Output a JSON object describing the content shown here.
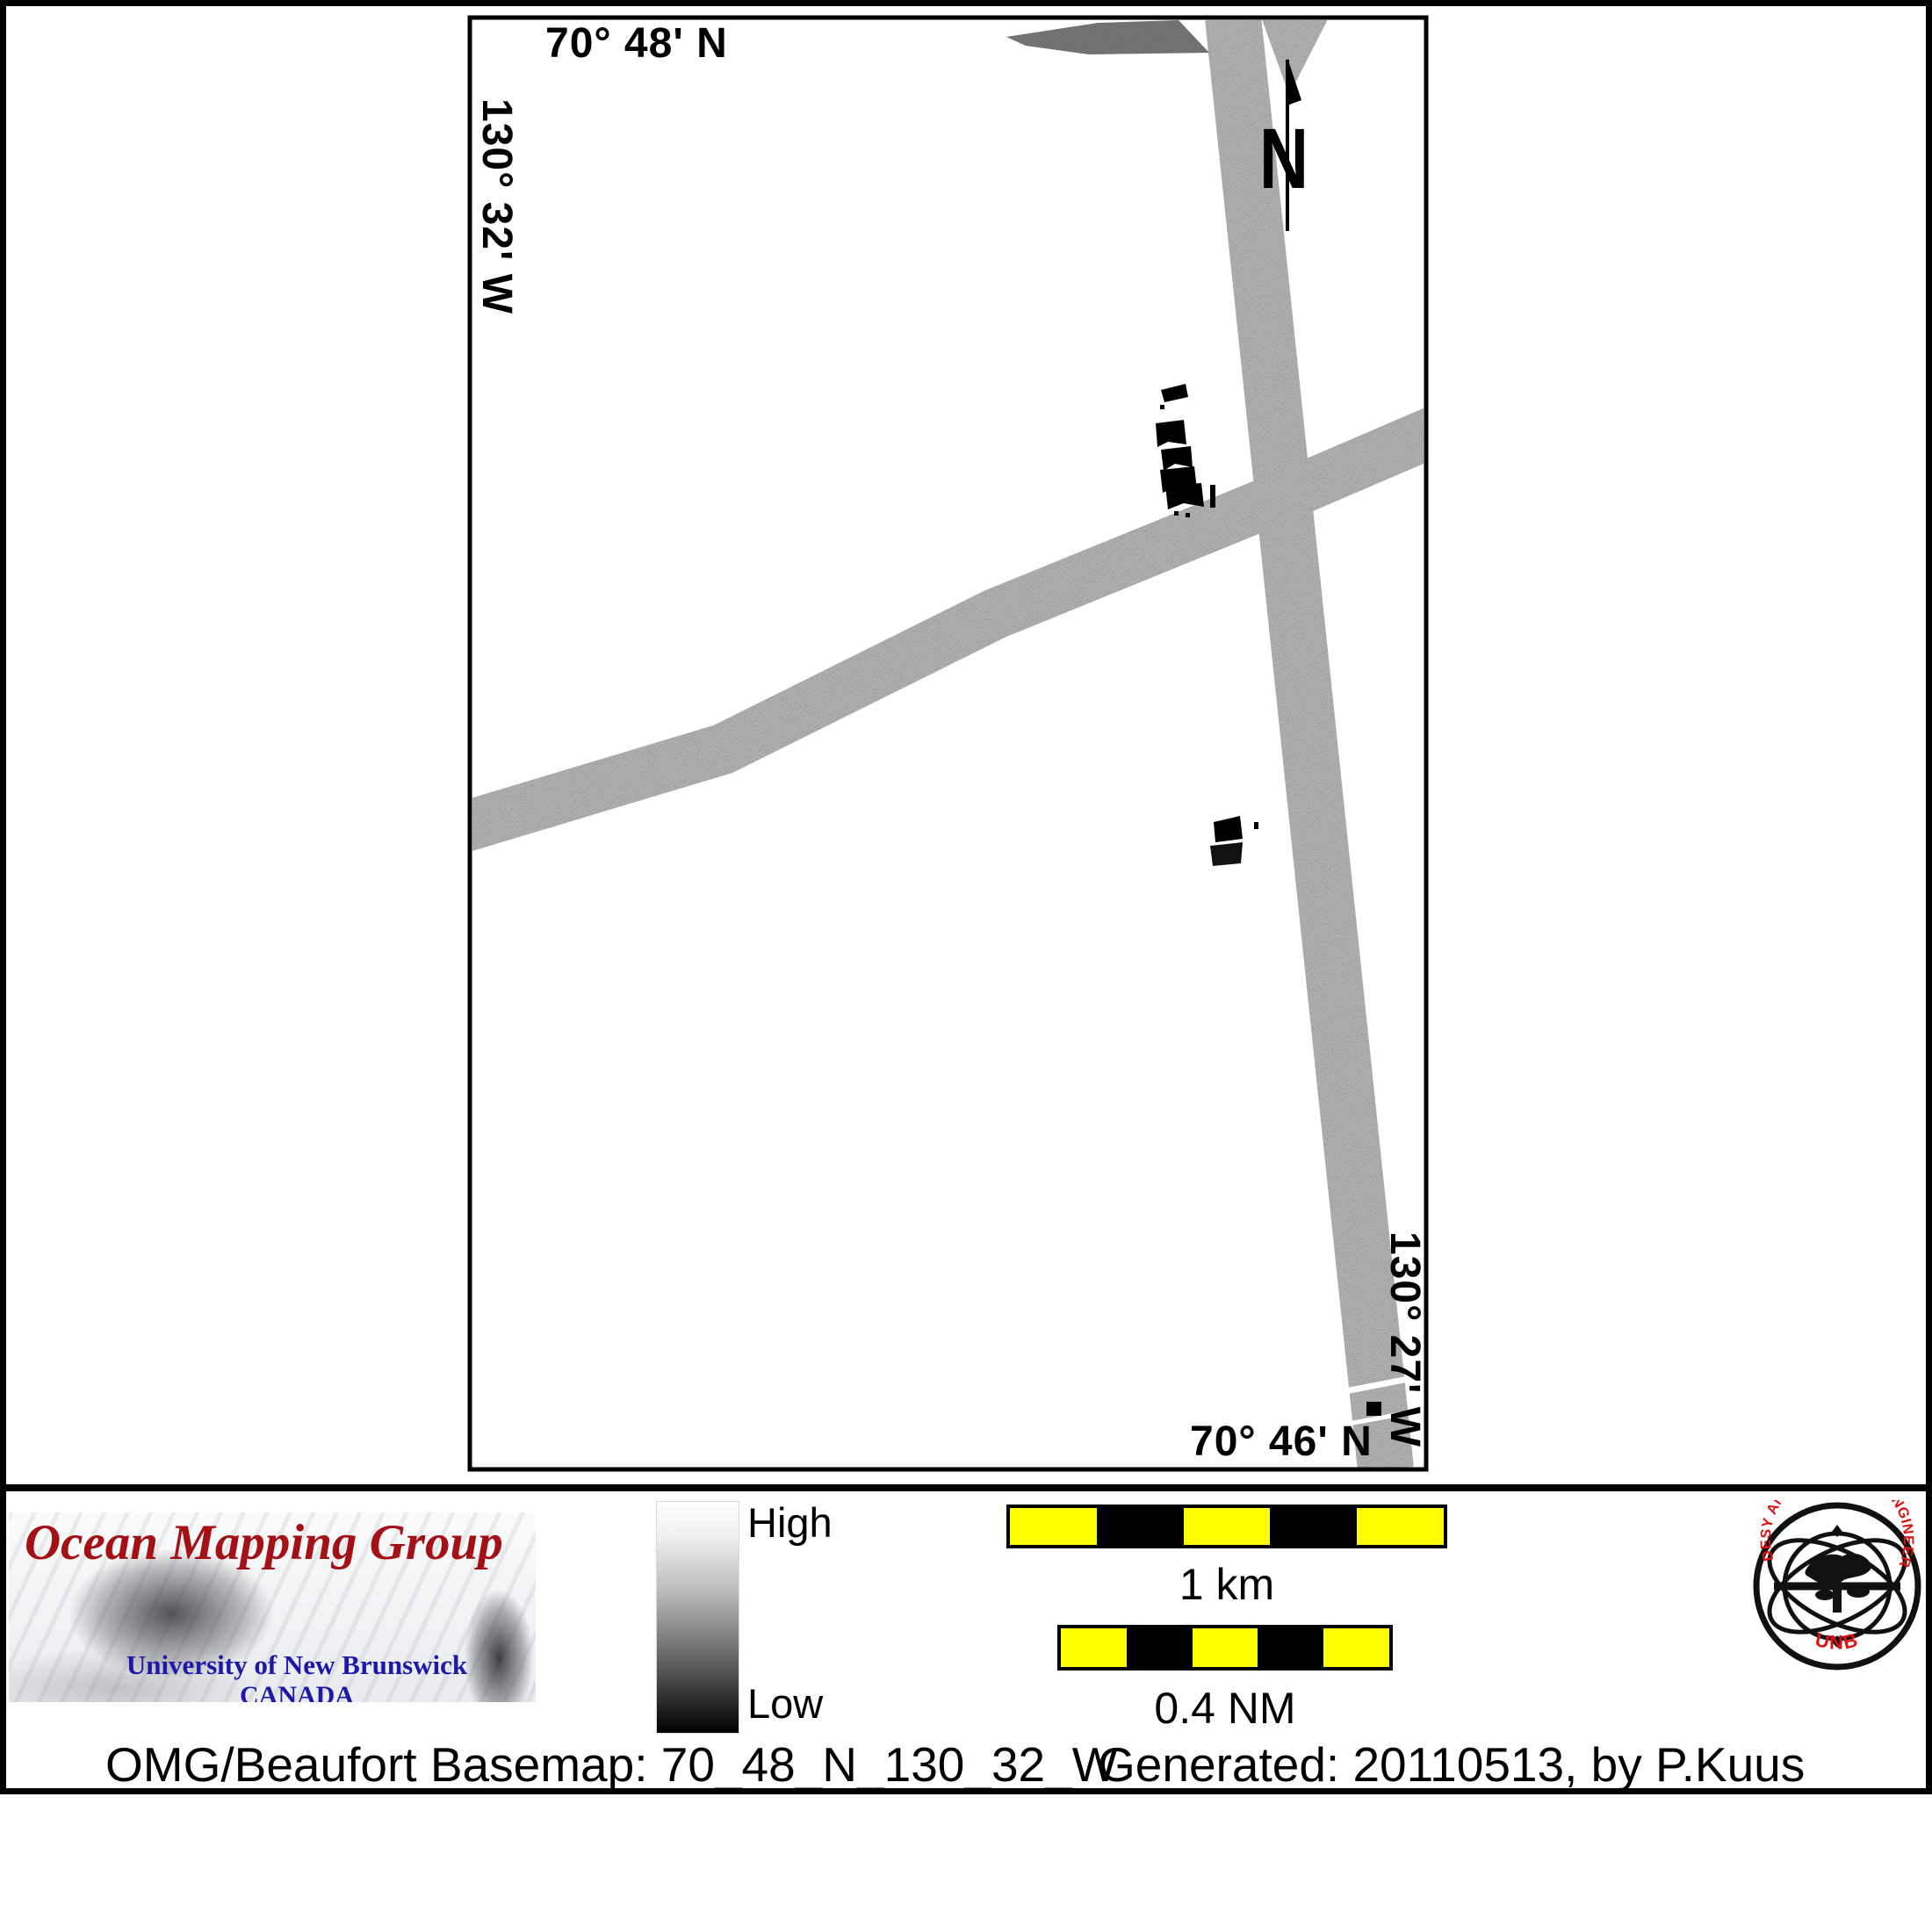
{
  "map": {
    "top_lat": "70° 48' N",
    "bottom_lat": "70° 46' N",
    "left_lon": "130° 32' W",
    "right_lon": "130° 27' W",
    "north_label": "N"
  },
  "legend": {
    "omg_logo": {
      "title": "Ocean Mapping Group",
      "subtitle1": "University of New Brunswick",
      "subtitle2": "CANADA"
    },
    "colorbar": {
      "high_label": "High",
      "low_label": "Low",
      "top_color": "#ffffff",
      "bottom_color": "#000000"
    },
    "scalebar_km": {
      "label": "1 km",
      "segments": [
        "#ffff00",
        "#000000",
        "#ffff00",
        "#000000",
        "#ffff00"
      ]
    },
    "scalebar_nm": {
      "label": "0.4 NM",
      "segments": [
        "#ffff00",
        "#000000",
        "#ffff00",
        "#000000",
        "#ffff00"
      ]
    },
    "seal": {
      "ring_text": "GEODESY AND GEOMATICS ENGINEERING",
      "bottom_text": "UNB"
    }
  },
  "footer": {
    "left_text": "OMG/Beaufort Basemap: 70_48_N_130_32_W",
    "right_text": "Generated: 20110513, by P.Kuus"
  },
  "colors": {
    "scale_yellow": "#ffff00",
    "seal_red": "#dd1111",
    "omg_title_red": "#a31117",
    "omg_blue": "#1d18a8",
    "swath_gray": "#b2b2b2"
  }
}
